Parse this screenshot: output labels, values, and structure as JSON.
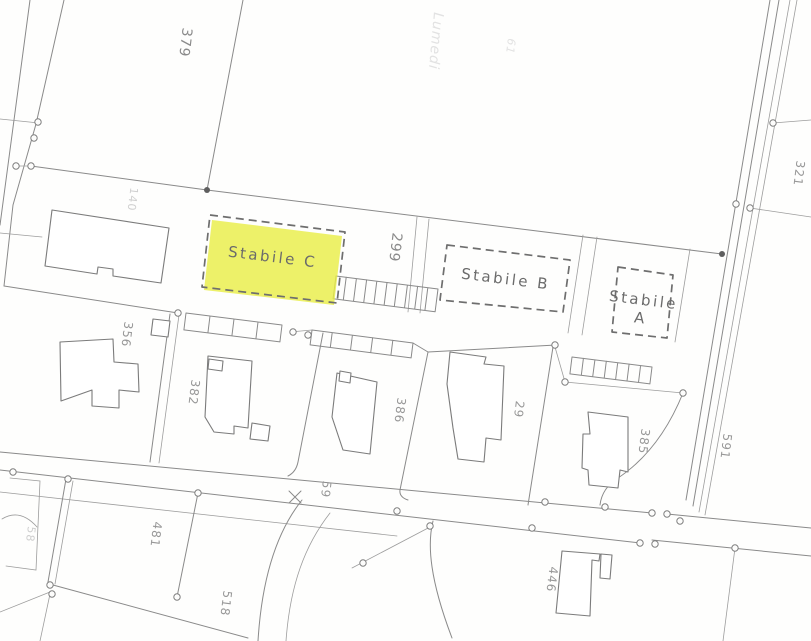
{
  "map": {
    "type": "cadastral-site-plan-scan",
    "colors": {
      "highlight_yellow": "#e9ee44",
      "line_gray": "#8a8a8a",
      "parcel_number_gray": "#979797",
      "stabile_label_gray": "#6b6b6b"
    },
    "stabile": {
      "c": "Stabile C",
      "b": "Stabile B",
      "a_line1": "Stabile",
      "a_line2": "A"
    },
    "parcels": [
      {
        "text": "379"
      },
      {
        "text": "140"
      },
      {
        "text": "299"
      },
      {
        "text": "321"
      },
      {
        "text": "356"
      },
      {
        "text": "382"
      },
      {
        "text": "386"
      },
      {
        "text": "29"
      },
      {
        "text": "385"
      },
      {
        "text": "591"
      },
      {
        "text": "59"
      },
      {
        "text": "481"
      },
      {
        "text": "58"
      },
      {
        "text": "518"
      },
      {
        "text": "446"
      }
    ],
    "artifacts": {
      "ghost_text": "Lumedi",
      "ghost_number": "61"
    }
  }
}
